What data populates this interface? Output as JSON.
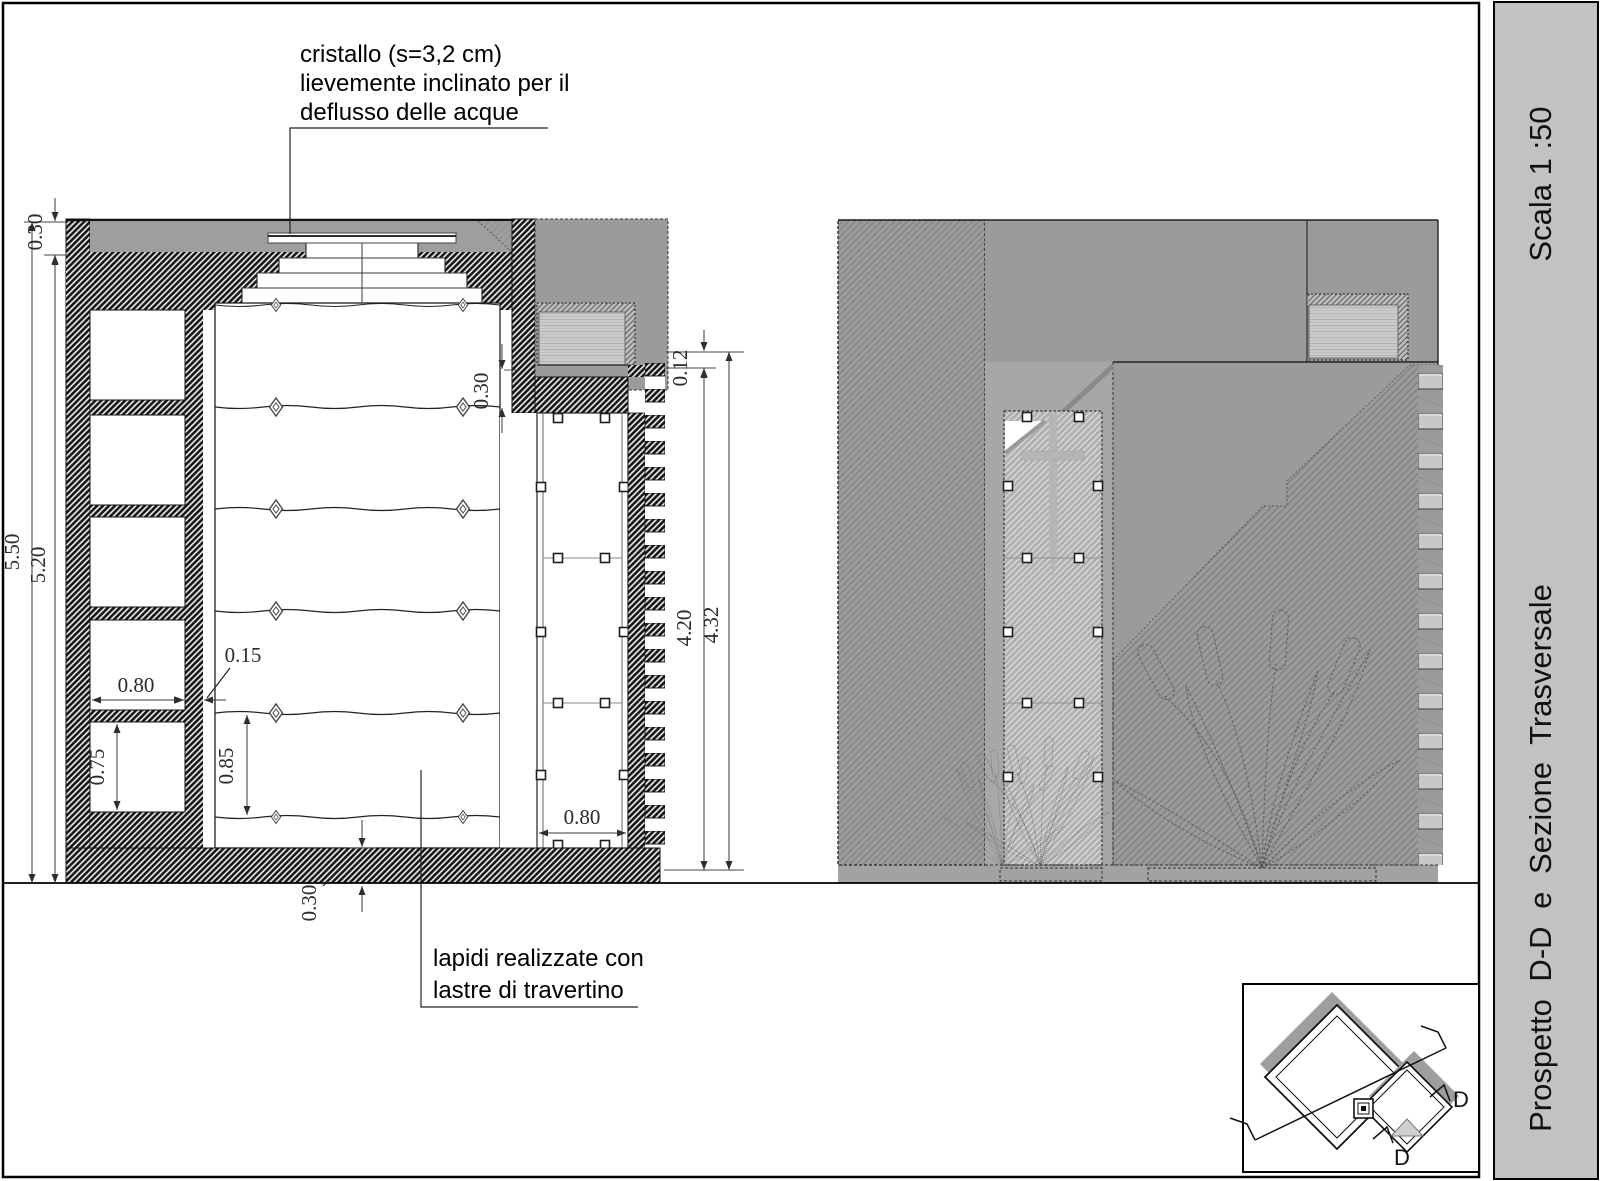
{
  "sidebar": {
    "scale_label": "Scala 1 :50",
    "title": "Prospetto D-D e Sezione Trasversale",
    "bg": "#c2c2c2"
  },
  "annotations": {
    "skylight": {
      "l1": "cristallo (s=3,2 cm)",
      "l2": "lievemente inclinato per il",
      "l3": "deflusso delle acque"
    },
    "slabs": {
      "l1": "lapidi realizzate con",
      "l2": "lastre di travertino"
    }
  },
  "dims": {
    "roof": "0.30",
    "total": "5.50",
    "inner": "5.20",
    "niche_w": "0.80",
    "niche_h": "0.75",
    "partition": "0.15",
    "slab": "0.85",
    "slab_top": "0.30",
    "floor": "0.30",
    "ledge": "0.12",
    "door_h": "4.20",
    "opening_h": "4.32",
    "door_w": "0.80"
  },
  "key_plan": {
    "d_right": "D",
    "d_bottom": "D"
  },
  "colors": {
    "cut_hatch": "#161616",
    "facade_gray": "#9b9b9b",
    "glass_gray": "#cacaca",
    "sidebar_bg": "#c2c2c2"
  }
}
